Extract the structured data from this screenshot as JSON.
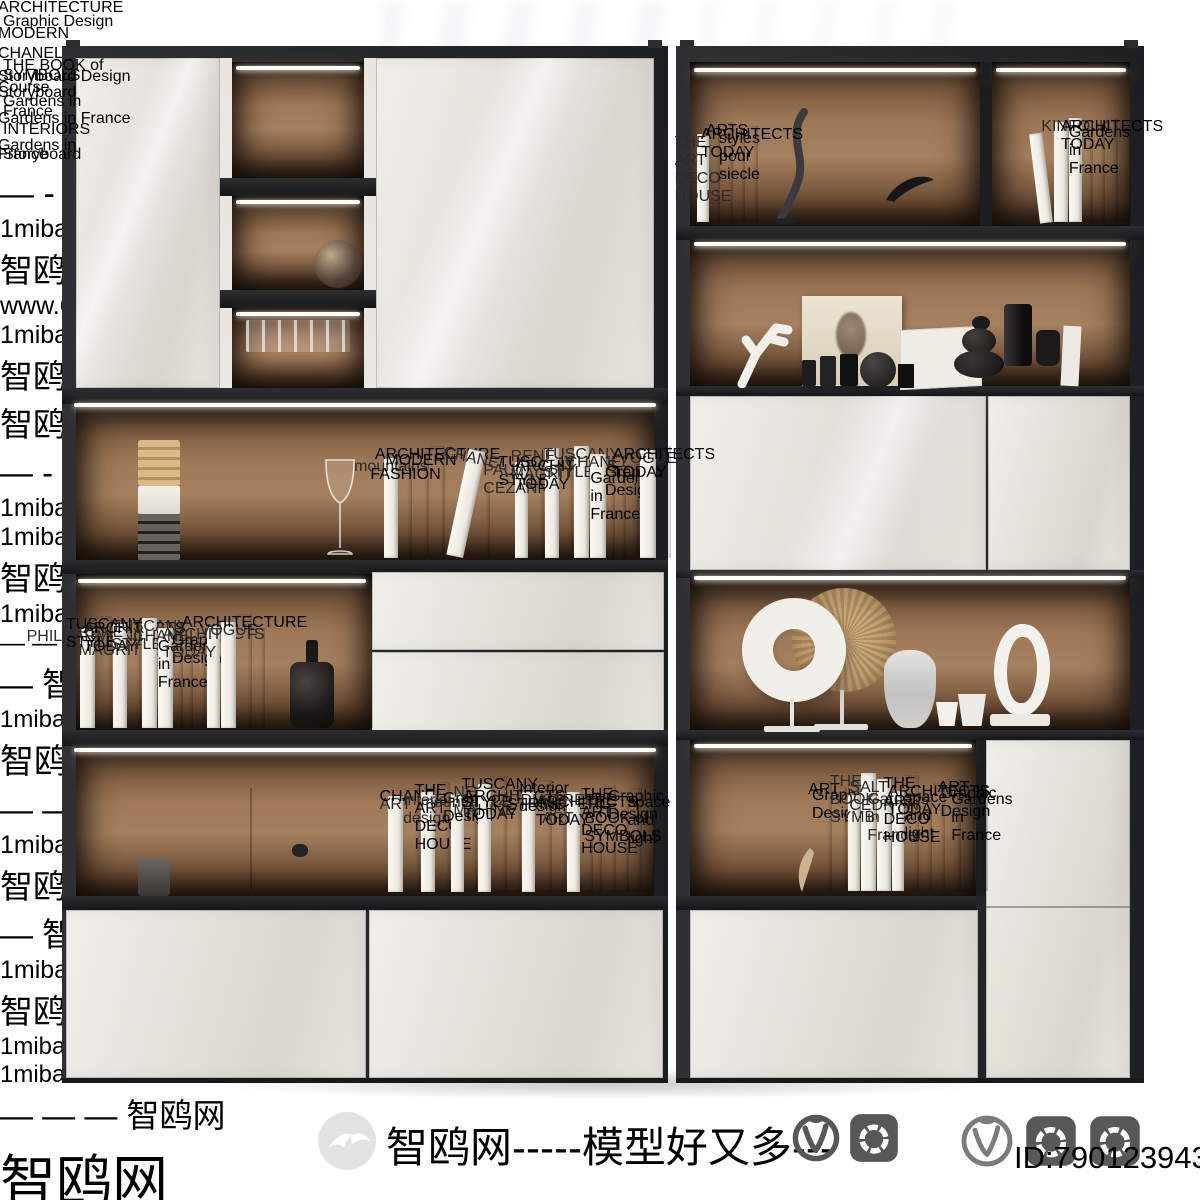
{
  "footer": {
    "brand_text": "智鸥网-----模型好又多---",
    "id_text": "ID:790123943",
    "icons": [
      "seagull-logo",
      "vray-icon",
      "corona-icon",
      "vray-outline-icon",
      "corona-icon",
      "corona-icon"
    ]
  },
  "colors": {
    "frame": "#24262a",
    "back_wall": "#a5805e",
    "door": "#e7e4de",
    "led": "#ffffff",
    "watermark_grey": "#7d7d7d",
    "book_black": "#1a1a1a",
    "book_white": "#f7f5f0"
  },
  "watermarks": [
    {
      "t": "— - — — 智鸥网 — — — — — —",
      "s": "o",
      "x": -28,
      "y": 62,
      "fs": 34
    },
    {
      "t": "1miba.com",
      "s": "g",
      "x": 646,
      "y": 60,
      "fs": 25
    },
    {
      "t": "智鸥网 — —",
      "s": "o",
      "x": 816,
      "y": 58,
      "fs": 33
    },
    {
      "t": "www.6m.cn",
      "s": "g",
      "x": 972,
      "y": 60,
      "fs": 25
    },
    {
      "t": "1miba.com",
      "s": "g",
      "x": 146,
      "y": 166,
      "fs": 25
    },
    {
      "t": "智鸥网",
      "s": "o",
      "x": 320,
      "y": 158,
      "fs": 33
    },
    {
      "t": "智鸥网 — — —",
      "s": "o",
      "x": 1076,
      "y": 146,
      "fs": 33
    },
    {
      "t": "— - — 智鸥网 — — — — —",
      "s": "o",
      "x": -30,
      "y": 298,
      "fs": 33
    },
    {
      "t": "1miba.com",
      "s": "g",
      "x": 250,
      "y": 300,
      "fs": 25
    },
    {
      "t": "1miba.com",
      "s": "g",
      "x": 232,
      "y": 382,
      "fs": 25
    },
    {
      "t": "智鸥网 — — — —",
      "s": "o",
      "x": 392,
      "y": 374,
      "fs": 33
    },
    {
      "t": "1miba.com — — — — — —",
      "s": "g",
      "x": 666,
      "y": 332,
      "fs": 25
    },
    {
      "t": "— — 1miba.com",
      "s": "g",
      "x": 1074,
      "y": 332,
      "fs": 25
    },
    {
      "t": "— 智鸥网 — — — —",
      "s": "o",
      "x": 40,
      "y": 588,
      "fs": 33
    },
    {
      "t": "1miba.com",
      "s": "g",
      "x": 210,
      "y": 592,
      "fs": 24
    },
    {
      "t": "智鸥网 — — — — 模型好又多",
      "s": "o",
      "x": 726,
      "y": 546,
      "fs": 34
    },
    {
      "t": "— — 智鸥网 — — — — —",
      "s": "o",
      "x": 140,
      "y": 668,
      "fs": 33
    },
    {
      "t": "1miba.com — — — — — —",
      "s": "g",
      "x": 922,
      "y": 652,
      "fs": 25
    },
    {
      "t": "智鸥网 —",
      "s": "o",
      "x": 1146,
      "y": 640,
      "fs": 33
    },
    {
      "t": "— 智鸥网 — — — — —",
      "s": "o",
      "x": 28,
      "y": 816,
      "fs": 33
    },
    {
      "t": "1miba.com",
      "s": "g",
      "x": 254,
      "y": 820,
      "fs": 25
    },
    {
      "t": "智鸥网 — — — —",
      "s": "o",
      "x": 900,
      "y": 762,
      "fs": 33
    },
    {
      "t": "1miba.com",
      "s": "g",
      "x": 1142,
      "y": 766,
      "fs": 24
    },
    {
      "t": "1miba.com",
      "s": "g",
      "x": 858,
      "y": 886,
      "fs": 24
    },
    {
      "t": "— — — 智鸥网",
      "s": "o",
      "x": 1008,
      "y": 880,
      "fs": 33
    },
    {
      "t": "智鸥网",
      "s": "o",
      "x": 986,
      "y": 1060,
      "fs": 56
    }
  ],
  "shelves": [
    {
      "name": "left-middle-shelf-books",
      "x": 384,
      "y": 558,
      "books": [
        [
          "mountains",
          "w",
          14,
          100
        ],
        [
          "FASHION",
          "b",
          13,
          92
        ],
        [
          "MODERN",
          "b",
          16,
          106
        ],
        [
          "ARCHITECTURE",
          "b",
          15,
          112
        ],
        [
          "CHANEL",
          "w",
          17,
          108,
          12
        ],
        [
          "",
          "b",
          10,
          72,
          0,
          16
        ],
        [
          "PAUL CEZANNE",
          "w",
          13,
          96,
          0,
          24
        ],
        [
          "TUSCANY STYLE",
          "b",
          15,
          104
        ],
        [
          "RENE MAGRITTE",
          "w",
          14,
          110
        ],
        [
          "ARCHITECTS TODAY",
          "g",
          13,
          100
        ],
        [
          "TUSCANY STYLE",
          "w",
          15,
          112
        ],
        [
          "CHANEL",
          "w",
          16,
          104
        ],
        [
          "",
          "b",
          8,
          96
        ],
        [
          "Gardens in France",
          "b",
          10,
          88
        ],
        [
          "Graphic Design",
          "g",
          12,
          94
        ],
        [
          "VOGUE",
          "w",
          16,
          108
        ],
        [
          "ARCHITECTS TODAY",
          "t",
          14,
          112
        ]
      ]
    },
    {
      "name": "left-lower-shelf-books",
      "x": 80,
      "y": 728,
      "books": [
        [
          "PHILHARMONIE",
          "w",
          15,
          100
        ],
        [
          "TUSCANY STYLE",
          "b",
          16,
          112
        ],
        [
          "RENE MAGRITTE",
          "w",
          14,
          104
        ],
        [
          "ARCHITECTS TODAY",
          "b",
          13,
          108
        ],
        [
          "TUSCANY STYLE",
          "w",
          15,
          110
        ],
        [
          "CHANEL",
          "w",
          15,
          100
        ],
        [
          "",
          "b",
          9,
          104
        ],
        [
          "Gardens in France",
          "b",
          9,
          90
        ],
        [
          "Graphic Design",
          "g",
          12,
          96
        ],
        [
          "ARCHITECTS TODAY",
          "w",
          13,
          102
        ],
        [
          "VOGUE",
          "w",
          15,
          106
        ],
        [
          "ARCHITECTURE",
          "b",
          15,
          114
        ],
        [
          "",
          "t",
          12,
          100
        ]
      ]
    },
    {
      "name": "left-bottom-shelf-books",
      "x": 388,
      "y": 892,
      "books": [
        [
          "ART",
          "w",
          15,
          96
        ],
        [
          "CHANEL",
          "b",
          16,
          104
        ],
        [
          "Interior design",
          "w",
          14,
          100
        ],
        [
          "THE ART DECO HOUSE",
          "b",
          14,
          110
        ],
        [
          "mountains",
          "w",
          13,
          98
        ],
        [
          "Graphic Design",
          "g",
          12,
          102
        ],
        [
          "NE MAHINE",
          "w",
          13,
          108
        ],
        [
          "TUSCANY STYLE",
          "b",
          15,
          116
        ],
        [
          "ARCHITECTS TODAY",
          "t",
          13,
          104
        ],
        [
          "ZODIAC",
          "w",
          13,
          100
        ],
        [
          "Interior design",
          "b",
          16,
          112
        ],
        [
          "STRINDBERG",
          "g",
          13,
          96
        ],
        [
          "STREET ART",
          "w",
          13,
          100
        ],
        [
          "ARCHITECTS TODAY",
          "t",
          12,
          98
        ],
        [
          "",
          "b",
          8,
          92
        ],
        [
          "THE ART DECO HOUSE",
          "b",
          13,
          106
        ],
        [
          "THE BOOK of SYMBOLS",
          "b",
          12,
          100
        ],
        [
          "Graphic Design",
          "b",
          12,
          104
        ],
        [
          "space and light",
          "b",
          12,
          98
        ]
      ]
    },
    {
      "name": "right-top-left-books",
      "x": 697,
      "y": 222,
      "books": [
        [
          "THE ART DECO HOUSE",
          "w",
          12,
          88
        ],
        [
          "",
          "b",
          10,
          96
        ],
        [
          "ARTS",
          "b",
          12,
          100
        ],
        [
          "styles pour siecle",
          "t",
          11,
          92
        ],
        [
          "ARCHITECTS TODAY",
          "g",
          12,
          96
        ]
      ]
    },
    {
      "name": "right-top-right-books",
      "x": 1040,
      "y": 222,
      "books": [
        [
          "",
          "w",
          13,
          90,
          -7
        ],
        [
          "",
          "w",
          14,
          100
        ],
        [
          "KINFOLK",
          "w",
          13,
          104
        ],
        [
          "",
          "b",
          10,
          96
        ],
        [
          "Gardens in France",
          "t",
          11,
          98
        ],
        [
          "ARCHITECTS TODAY",
          "b",
          12,
          104
        ],
        [
          "",
          "g",
          12,
          96
        ]
      ]
    },
    {
      "name": "right-bottom-shelf-books",
      "x": 816,
      "y": 891,
      "books": [
        [
          "ART",
          "b",
          16,
          110
        ],
        [
          "Graphic Design",
          "b",
          14,
          104
        ],
        [
          "",
          "w",
          12,
          96
        ],
        [
          "THE BOOK of SYMBOLS",
          "w",
          15,
          118
        ],
        [
          "SALT CEDRON",
          "w",
          14,
          112
        ],
        [
          "Gardens in France",
          "w",
          12,
          100
        ],
        [
          "THE ART DECO HOUSE",
          "b",
          14,
          116
        ],
        [
          "space and light",
          "b",
          12,
          102
        ],
        [
          "ARCHITECTS TODAY",
          "t",
          12,
          108
        ],
        [
          "ART",
          "b",
          15,
          112
        ],
        [
          "Graphic Design",
          "b",
          13,
          106
        ],
        [
          "Gardens in France",
          "b",
          12,
          100
        ]
      ]
    }
  ],
  "stacks": [
    {
      "name": "decanter-book-stack",
      "x": 240,
      "y": 178,
      "books": [
        [
          "ARCHITECTURE",
          150,
          16,
          "b"
        ],
        [
          "Graphic Design",
          140,
          11,
          "b"
        ],
        [
          "MODERN",
          152,
          13,
          "d"
        ]
      ]
    },
    {
      "name": "chanel-book-stack",
      "x": 238,
      "y": 388,
      "books": [
        [
          "CHANEL",
          148,
          15,
          "b"
        ],
        [
          "THE BOOK of SYMBOLS",
          156,
          10,
          "b"
        ],
        [
          "Storyboard Design Course",
          166,
          11,
          "b"
        ]
      ]
    },
    {
      "name": "horn-book-stack",
      "x": 836,
      "y": 224,
      "books": [
        [
          "Storyboard",
          122,
          9,
          "b"
        ],
        [
          "Gardens in France",
          130,
          10,
          "b"
        ]
      ]
    },
    {
      "name": "pebble-book-stack",
      "x": 944,
      "y": 386,
      "books": [
        [
          "Gardens in France",
          150,
          11,
          "b"
        ],
        [
          "INTERIORS",
          160,
          11,
          "b"
        ]
      ]
    },
    {
      "name": "card-book-stack",
      "x": 212,
      "y": 892,
      "books": [
        [
          "Gardens in France",
          130,
          9,
          "b"
        ],
        [
          "Storyboard",
          142,
          10,
          "b"
        ]
      ]
    }
  ]
}
